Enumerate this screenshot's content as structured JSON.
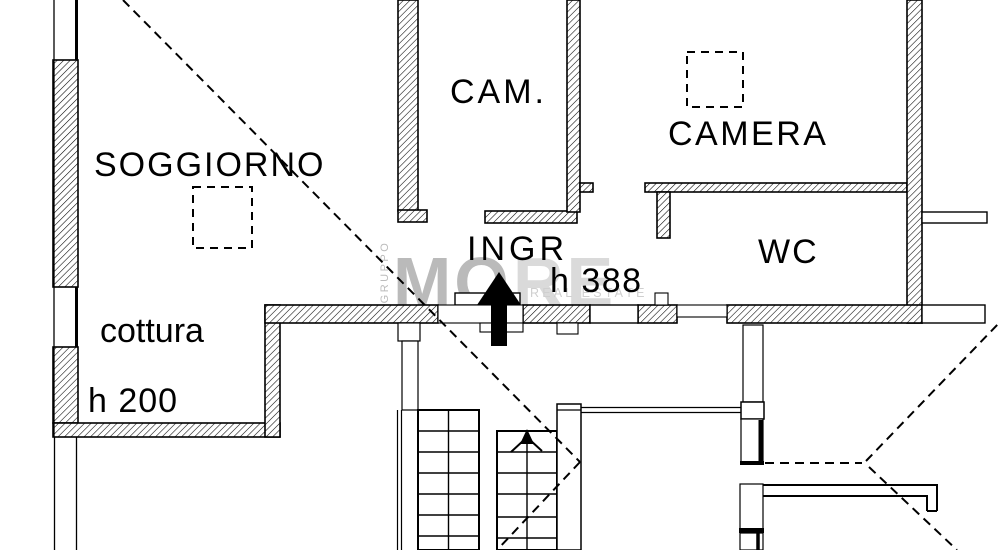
{
  "plan": {
    "type": "apartment floor plan",
    "rooms": {
      "soggiorno": {
        "label": "SOGGIORNO"
      },
      "cam": {
        "label": "CAM."
      },
      "camera": {
        "label": "CAMERA"
      },
      "wc": {
        "label": "WC"
      },
      "ingresso": {
        "label": "INGR"
      },
      "cottura": {
        "label": "cottura"
      }
    },
    "annotations": {
      "ingresso_height": "h 388",
      "cottura_height": "h 200"
    }
  },
  "watermark": {
    "side_text": "GRUPPO",
    "brand_part1": "MO",
    "brand_part2": "RE",
    "tagline": "REAL ESTATE"
  },
  "colors": {
    "line": "#000000",
    "background": "#ffffff",
    "watermark_dark": "#b9b9b9",
    "watermark_light": "#dadada",
    "watermark_tagline": "#cfcfcf"
  }
}
